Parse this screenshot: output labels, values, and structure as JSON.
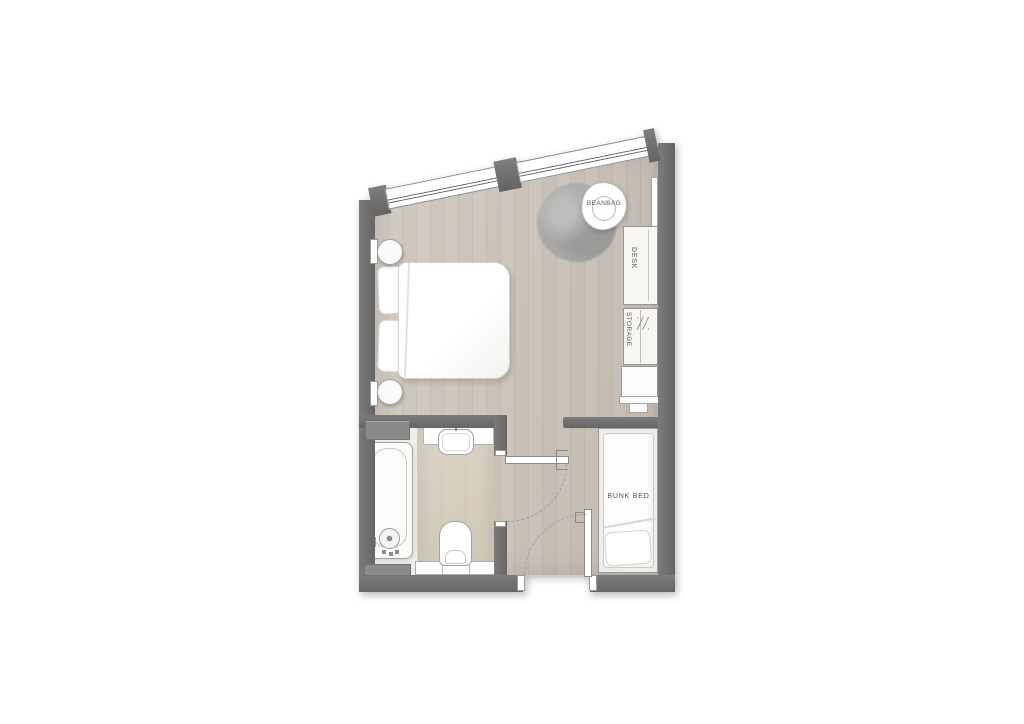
{
  "floorplan": {
    "labels": {
      "beanbag": "BEANBAG",
      "desk": "DESK",
      "storage": "STORAGE",
      "bunk_bed": "BUNK BED"
    },
    "colors": {
      "wall": "#6f6f6f",
      "wood_floor": "#c7bfb5",
      "bathroom_floor": "#d7cebe",
      "tub_zone_floor": "#f0eee9",
      "rug": "#a6a6a6",
      "fixture_fill": "#fdfdfd",
      "fixture_outline": "#a5a5a5",
      "label_text": "#555555"
    }
  }
}
